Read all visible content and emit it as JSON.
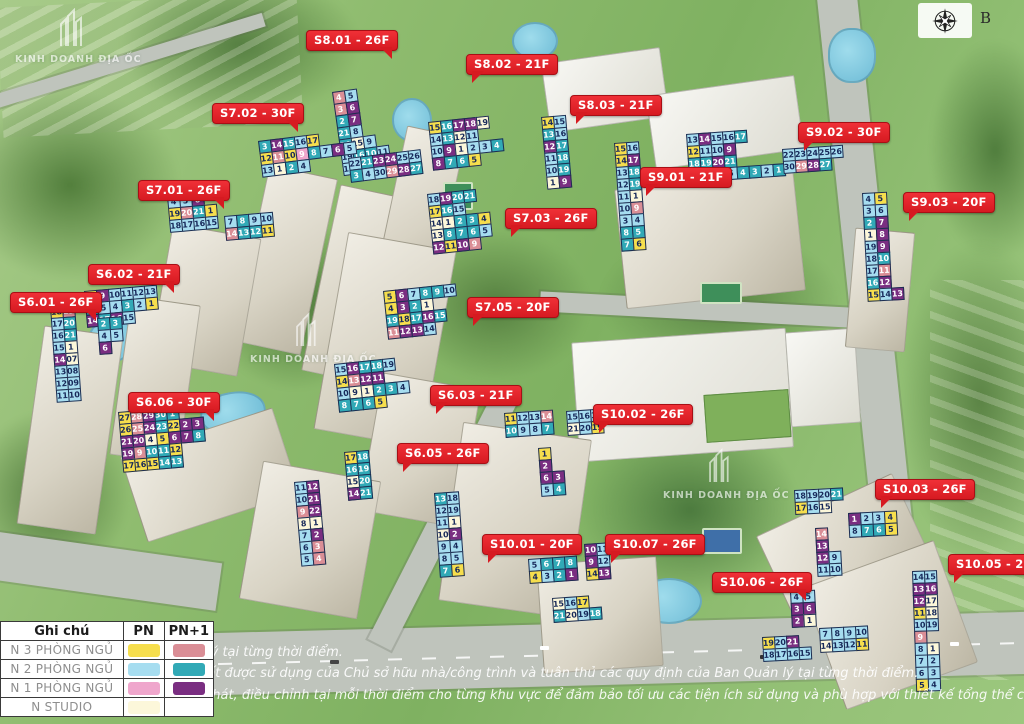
{
  "compass": {
    "letter": "B"
  },
  "watermark": {
    "brand": "KINH DOANH ĐỊA ỐC"
  },
  "disclaimer": [
    "lý tại từng thời điểm.",
    "đất được sử dụng của Chủ sở hữu nhà/công trình và tuân thủ các quy định của Ban Quản lý tại từng thời điểm.",
    "phát, điều chỉnh tại mỗi thời điểm cho từng khu vực để đảm bảo tối ưu các tiện ích sử dụng và phù hợp với thiết kế tổng thể của Dự Án."
  ],
  "legend": {
    "header": {
      "col1": "Ghi chú",
      "col2": "PN",
      "col3": "PN+1"
    },
    "rows": [
      {
        "label": "N 3 PHÒNG NGỦ",
        "pn": "y",
        "pn1": "s"
      },
      {
        "label": "N 2 PHÒNG NGỦ",
        "pn": "c",
        "pn1": "t"
      },
      {
        "label": "N 1 PHÒNG NGỦ",
        "pn": "p",
        "pn1": "v"
      },
      {
        "label": "N STUDIO",
        "pn": "w",
        "pn1": null
      }
    ]
  },
  "colors": {
    "y": "#F6DE4D",
    "s": "#DA8E96",
    "c": "#A6DDF0",
    "t": "#31A9B6",
    "p": "#EFA6CC",
    "v": "#7A2E81",
    "w": "#FCF7DA"
  },
  "badge_color": "#E2211C",
  "badges": [
    {
      "label": "S8.01 - 26F",
      "x": 306,
      "y": 30,
      "tail": "br"
    },
    {
      "label": "S8.02 - 21F",
      "x": 466,
      "y": 54,
      "tail": "bl"
    },
    {
      "label": "S8.03 - 21F",
      "x": 570,
      "y": 95,
      "tail": "bl"
    },
    {
      "label": "S7.02 - 30F",
      "x": 212,
      "y": 103,
      "tail": "br"
    },
    {
      "label": "S9.02 - 30F",
      "x": 798,
      "y": 122,
      "tail": "bl"
    },
    {
      "label": "S7.01 - 26F",
      "x": 138,
      "y": 180,
      "tail": "br"
    },
    {
      "label": "S9.01 - 21F",
      "x": 640,
      "y": 167,
      "tail": "bl"
    },
    {
      "label": "S9.03 - 20F",
      "x": 903,
      "y": 192,
      "tail": "bl"
    },
    {
      "label": "S7.03 - 26F",
      "x": 505,
      "y": 208,
      "tail": "bl"
    },
    {
      "label": "S6.02 - 21F",
      "x": 88,
      "y": 264,
      "tail": "br"
    },
    {
      "label": "S6.01 - 26F",
      "x": 10,
      "y": 292,
      "tail": "br"
    },
    {
      "label": "S7.05 - 20F",
      "x": 467,
      "y": 297,
      "tail": "bl"
    },
    {
      "label": "S6.03 - 21F",
      "x": 430,
      "y": 385,
      "tail": "bl"
    },
    {
      "label": "S6.06 - 30F",
      "x": 128,
      "y": 392,
      "tail": "br"
    },
    {
      "label": "S10.02 - 26F",
      "x": 593,
      "y": 404,
      "tail": "bl"
    },
    {
      "label": "S6.05 - 26F",
      "x": 397,
      "y": 443,
      "tail": "bl"
    },
    {
      "label": "S10.03 - 26F",
      "x": 875,
      "y": 479,
      "tail": "bl"
    },
    {
      "label": "S10.01 - 20F",
      "x": 482,
      "y": 534,
      "tail": "bl"
    },
    {
      "label": "S10.07 - 26F",
      "x": 605,
      "y": 534,
      "tail": "bl"
    },
    {
      "label": "S10.06 - 26F",
      "x": 712,
      "y": 572,
      "tail": "br"
    },
    {
      "label": "S10.05 - 20F",
      "x": 948,
      "y": 554,
      "tail": "bl"
    }
  ],
  "grids": [
    {
      "building": "S8.01",
      "x": 332,
      "y": 92,
      "rot": -8,
      "rows": [
        [
          "4|s",
          "5|c"
        ],
        [
          "3|s",
          "6|v"
        ],
        [
          "2|t",
          "7|v"
        ],
        [
          "21|t",
          "8|c"
        ],
        [
          "20|t",
          "15|w",
          "9|c"
        ],
        [
          "19|c",
          "16|t",
          "10|t",
          "11|c"
        ],
        [
          "18|c",
          "17|y"
        ]
      ]
    },
    {
      "building": "S7.02-a",
      "x": 258,
      "y": 141,
      "rot": -7,
      "rows": [
        [
          "3|t",
          "14|v",
          "15|t",
          "16|c",
          "17|y"
        ],
        [
          "12|y",
          "11|s",
          "10|y",
          "9|p",
          "8|t",
          "7|c",
          "6|v",
          "5|c"
        ],
        [
          "13|c",
          "1|w",
          "2|t",
          "4|c"
        ]
      ]
    },
    {
      "building": "S7.02-b",
      "x": 348,
      "y": 158,
      "rot": -7,
      "rows": [
        [
          "22|c",
          "21|t",
          "23|v",
          "24|v",
          "25|c",
          "26|c"
        ],
        [
          "3|t",
          "4|c",
          "30|c",
          "29|s",
          "28|v",
          "27|t"
        ]
      ]
    },
    {
      "building": "S7.01-a",
      "x": 167,
      "y": 196,
      "rot": -5,
      "rows": [
        [
          "4|c",
          "5|c",
          "6|v"
        ],
        [
          "19|y",
          "20|s",
          "21|t",
          "1|y"
        ],
        [
          "18|c",
          "17|c",
          "16|c",
          "15|c"
        ]
      ]
    },
    {
      "building": "S7.01-b",
      "x": 224,
      "y": 216,
      "rot": -5,
      "rows": [
        [
          "7|c",
          "8|t",
          "9|c",
          "10|c"
        ],
        [
          "14|s",
          "13|t",
          "12|t",
          "11|y"
        ]
      ]
    },
    {
      "building": "S6.02",
      "x": 84,
      "y": 291,
      "rot": -5,
      "rows": [
        [
          "7|y",
          "9|v",
          "10|c",
          "11|c",
          "12|c",
          "13|c"
        ],
        [
          "8|t",
          "5|c",
          "4|c",
          "3|t",
          "2|c",
          "1|y"
        ],
        [
          "14|v",
          "17|t",
          "16|v",
          "15|c"
        ]
      ]
    },
    {
      "building": "S6.01-a",
      "x": 50,
      "y": 306,
      "rot": -4,
      "rows": [
        [
          "18|y",
          "19|s"
        ],
        [
          "17|c",
          "20|t"
        ],
        [
          "16|c",
          "21|t"
        ],
        [
          "15|c",
          "1|w"
        ],
        [
          "14|v",
          "07|w"
        ],
        [
          "13|c",
          "08|c"
        ],
        [
          "12|c",
          "09|c"
        ],
        [
          "11|c",
          "10|c"
        ]
      ]
    },
    {
      "building": "S6.01-b",
      "x": 97,
      "y": 318,
      "rot": -4,
      "rows": [
        [
          "2|t",
          "3|t"
        ],
        [
          "4|c",
          "5|c"
        ],
        [
          "6|v"
        ]
      ]
    },
    {
      "building": "S6.06",
      "x": 118,
      "y": 412,
      "rot": -5,
      "rows": [
        [
          "27|y",
          "28|s",
          "29|v",
          "30|t",
          "1|t"
        ],
        [
          "26|y",
          "25|s",
          "24|v",
          "23|t",
          "22|y",
          "2|v",
          "3|v"
        ],
        [
          "21|v",
          "20|v",
          "4|w",
          "5|y",
          "6|v",
          "7|v",
          "8|t"
        ],
        [
          "19|v",
          "9|s",
          "10|t",
          "11|t",
          "12|y"
        ],
        [
          "17|y",
          "16|y",
          "15|y",
          "14|t",
          "13|t"
        ]
      ]
    },
    {
      "building": "S8.02",
      "x": 428,
      "y": 122,
      "rot": -6,
      "rows": [
        [
          "15|y",
          "16|t",
          "17|v",
          "18|v",
          "19|w"
        ],
        [
          "14|c",
          "13|t",
          "12|w",
          "11|c"
        ],
        [
          "10|c",
          "9|v",
          "1|w",
          "2|c",
          "3|c",
          "4|t"
        ],
        [
          "8|v",
          "7|t",
          "6|t",
          "5|y"
        ]
      ]
    },
    {
      "building": "S8.03",
      "x": 541,
      "y": 117,
      "rot": -5,
      "rows": [
        [
          "14|y",
          "15|c"
        ],
        [
          "13|t",
          "16|c"
        ],
        [
          "12|v",
          "17|t"
        ],
        [
          "11|c",
          "18|t"
        ],
        [
          "10|c",
          "19|t"
        ],
        [
          "1|w",
          "9|v"
        ]
      ]
    },
    {
      "building": "S9.01-w",
      "x": 614,
      "y": 143,
      "rot": -4,
      "rows": [
        [
          "15|y",
          "16|c"
        ],
        [
          "14|y",
          "17|v"
        ],
        [
          "13|c",
          "18|t"
        ],
        [
          "12|c",
          "19|t"
        ],
        [
          "11|c",
          "1|w"
        ],
        [
          "10|c",
          "9|s"
        ],
        [
          "3|c",
          "4|c"
        ],
        [
          "8|t",
          "5|t"
        ],
        [
          "7|t",
          "6|y"
        ]
      ]
    },
    {
      "building": "S9.01",
      "x": 686,
      "y": 134,
      "rot": -4,
      "rows": [
        [
          "13|c",
          "14|v",
          "15|c",
          "16|c",
          "17|t"
        ],
        [
          "12|y",
          "11|c",
          "10|c",
          "9|v"
        ],
        [
          "18|t",
          "19|t",
          "20|v",
          "21|t"
        ],
        [
          "8|c",
          "7|v",
          "6|c",
          "5|c",
          "4|t",
          "3|t",
          "2|c",
          "1|t"
        ]
      ]
    },
    {
      "building": "S9.02",
      "x": 782,
      "y": 149,
      "rot": -4,
      "rows": [
        [
          "22|c",
          "23|c",
          "24|c",
          "25|c",
          "26|c"
        ],
        [
          "30|c",
          "29|s",
          "28|v",
          "27|t"
        ]
      ]
    },
    {
      "building": "S9.03",
      "x": 862,
      "y": 193,
      "rot": -3,
      "rows": [
        [
          "4|c",
          "5|y"
        ],
        [
          "3|c",
          "6|c"
        ],
        [
          "2|t",
          "7|v"
        ],
        [
          "1|w",
          "8|v"
        ],
        [
          "19|c",
          "9|v"
        ],
        [
          "18|c",
          "10|t"
        ],
        [
          "17|c",
          "11|s"
        ],
        [
          "16|t",
          "12|v"
        ],
        [
          "15|y",
          "14|c",
          "13|v"
        ]
      ]
    },
    {
      "building": "S7.03",
      "x": 427,
      "y": 194,
      "rot": -6,
      "rows": [
        [
          "18|c",
          "19|v",
          "20|t",
          "21|t"
        ],
        [
          "17|y",
          "16|t",
          "15|c"
        ],
        [
          "14|w",
          "1|w",
          "2|t",
          "3|t",
          "4|y"
        ],
        [
          "13|w",
          "8|t",
          "7|t",
          "6|t",
          "5|c"
        ],
        [
          "12|v",
          "11|y",
          "10|v",
          "9|s"
        ]
      ]
    },
    {
      "building": "S7.05",
      "x": 383,
      "y": 291,
      "rot": -6,
      "rows": [
        [
          "5|y",
          "6|v",
          "7|c",
          "8|t",
          "9|t",
          "10|c"
        ],
        [
          "4|y",
          "3|v",
          "2|t",
          "1|w"
        ],
        [
          "19|t",
          "18|y",
          "17|t",
          "16|v",
          "15|t"
        ],
        [
          "11|s",
          "12|v",
          "13|v",
          "14|c"
        ]
      ]
    },
    {
      "building": "S6.03",
      "x": 334,
      "y": 364,
      "rot": -6,
      "rows": [
        [
          "15|c",
          "16|v",
          "17|t",
          "18|t",
          "19|c"
        ],
        [
          "14|y",
          "13|s",
          "12|v",
          "11|v"
        ],
        [
          "10|c",
          "9|w",
          "1|w",
          "2|t",
          "3|t",
          "4|c"
        ],
        [
          "8|t",
          "7|t",
          "6|t",
          "5|y"
        ]
      ]
    },
    {
      "building": "S6.05-a",
      "x": 294,
      "y": 482,
      "rot": -5,
      "rows": [
        [
          "11|c",
          "12|v"
        ],
        [
          "10|c",
          "21|v"
        ],
        [
          "9|s",
          "22|v"
        ],
        [
          "8|w",
          "1|w"
        ],
        [
          "7|c",
          "2|v"
        ],
        [
          "6|c",
          "3|s"
        ],
        [
          "5|c",
          "4|s"
        ]
      ]
    },
    {
      "building": "S6.05-b",
      "x": 344,
      "y": 452,
      "rot": -5,
      "rows": [
        [
          "17|y",
          "18|t"
        ],
        [
          "16|t",
          "19|t"
        ],
        [
          "15|w",
          "20|t"
        ],
        [
          "14|v",
          "21|t"
        ]
      ]
    },
    {
      "building": "S10.02-a",
      "x": 504,
      "y": 413,
      "rot": -4,
      "rows": [
        [
          "11|y",
          "12|c",
          "13|c",
          "14|s"
        ],
        [
          "10|t",
          "9|c",
          "8|c",
          "7|t"
        ]
      ]
    },
    {
      "building": "S10.02-b",
      "x": 566,
      "y": 411,
      "rot": -4,
      "rows": [
        [
          "15|c",
          "16|c",
          "17|c",
          "18|t"
        ],
        [
          "21|w",
          "20|c",
          "19|y"
        ]
      ]
    },
    {
      "building": "S10.02-c",
      "x": 538,
      "y": 448,
      "rot": -4,
      "rows": [
        [
          "1|y"
        ],
        [
          "2|v"
        ],
        [
          "6|v",
          "3|v"
        ],
        [
          "5|c",
          "4|t"
        ]
      ]
    },
    {
      "building": "S10.01",
      "x": 434,
      "y": 493,
      "rot": -4,
      "rows": [
        [
          "13|t",
          "18|c"
        ],
        [
          "12|c",
          "19|c"
        ],
        [
          "11|c",
          "1|w"
        ],
        [
          "10|w",
          "2|v"
        ],
        [
          "9|c",
          "4|c"
        ],
        [
          "8|c",
          "5|c"
        ],
        [
          "7|t",
          "6|y"
        ]
      ]
    },
    {
      "building": "S10.07-a",
      "x": 528,
      "y": 559,
      "rot": -4,
      "rows": [
        [
          "5|c",
          "6|t",
          "7|t",
          "8|t"
        ],
        [
          "4|y",
          "3|c",
          "2|t",
          "1|v"
        ]
      ]
    },
    {
      "building": "S10.07-b",
      "x": 584,
      "y": 544,
      "rot": -4,
      "rows": [
        [
          "10|v",
          "11|c"
        ],
        [
          "9|v",
          "12|c"
        ],
        [
          "14|y",
          "13|v"
        ]
      ]
    },
    {
      "building": "S10.07-c",
      "x": 552,
      "y": 598,
      "rot": -4,
      "rows": [
        [
          "15|w",
          "16|c",
          "17|y"
        ],
        [
          "21|t",
          "20|w",
          "19|c",
          "18|t"
        ]
      ]
    },
    {
      "building": "S10.03-a",
      "x": 794,
      "y": 490,
      "rot": -3,
      "rows": [
        [
          "18|c",
          "19|c",
          "20|c",
          "21|t"
        ],
        [
          "17|y",
          "16|c",
          "15|w"
        ]
      ]
    },
    {
      "building": "S10.03-b",
      "x": 848,
      "y": 513,
      "rot": -3,
      "rows": [
        [
          "1|v",
          "2|c",
          "3|c",
          "4|y"
        ],
        [
          "8|c",
          "7|t",
          "6|t",
          "5|y"
        ]
      ]
    },
    {
      "building": "S10.03-c",
      "x": 815,
      "y": 528,
      "rot": -3,
      "rows": [
        [
          "14|s"
        ],
        [
          "13|v"
        ],
        [
          "12|v",
          "9|c"
        ],
        [
          "11|c",
          "10|c"
        ]
      ]
    },
    {
      "building": "S10.06-a",
      "x": 790,
      "y": 591,
      "rot": -3,
      "rows": [
        [
          "4|c",
          "5|c"
        ],
        [
          "3|v",
          "6|v"
        ],
        [
          "2|v",
          "1|w"
        ]
      ]
    },
    {
      "building": "S10.06-b",
      "x": 819,
      "y": 628,
      "rot": -3,
      "rows": [
        [
          "7|c",
          "8|c",
          "9|c",
          "10|c"
        ],
        [
          "14|w",
          "13|c",
          "12|c",
          "11|y"
        ]
      ]
    },
    {
      "building": "S10.06-c",
      "x": 762,
      "y": 637,
      "rot": -3,
      "rows": [
        [
          "19|y",
          "20|c",
          "21|v"
        ],
        [
          "18|c",
          "17|c",
          "16|c",
          "15|c"
        ]
      ]
    },
    {
      "building": "S10.05",
      "x": 912,
      "y": 571,
      "rot": -2,
      "rows": [
        [
          "14|c",
          "15|c"
        ],
        [
          "13|v",
          "16|v"
        ],
        [
          "12|v",
          "17|w"
        ],
        [
          "11|y",
          "18|w"
        ],
        [
          "10|c",
          "19|c"
        ],
        [
          "9|s"
        ],
        [
          "8|c",
          "1|w"
        ],
        [
          "7|c",
          "2|c"
        ],
        [
          "6|c",
          "3|c"
        ],
        [
          "5|y",
          "4|c"
        ]
      ]
    }
  ]
}
